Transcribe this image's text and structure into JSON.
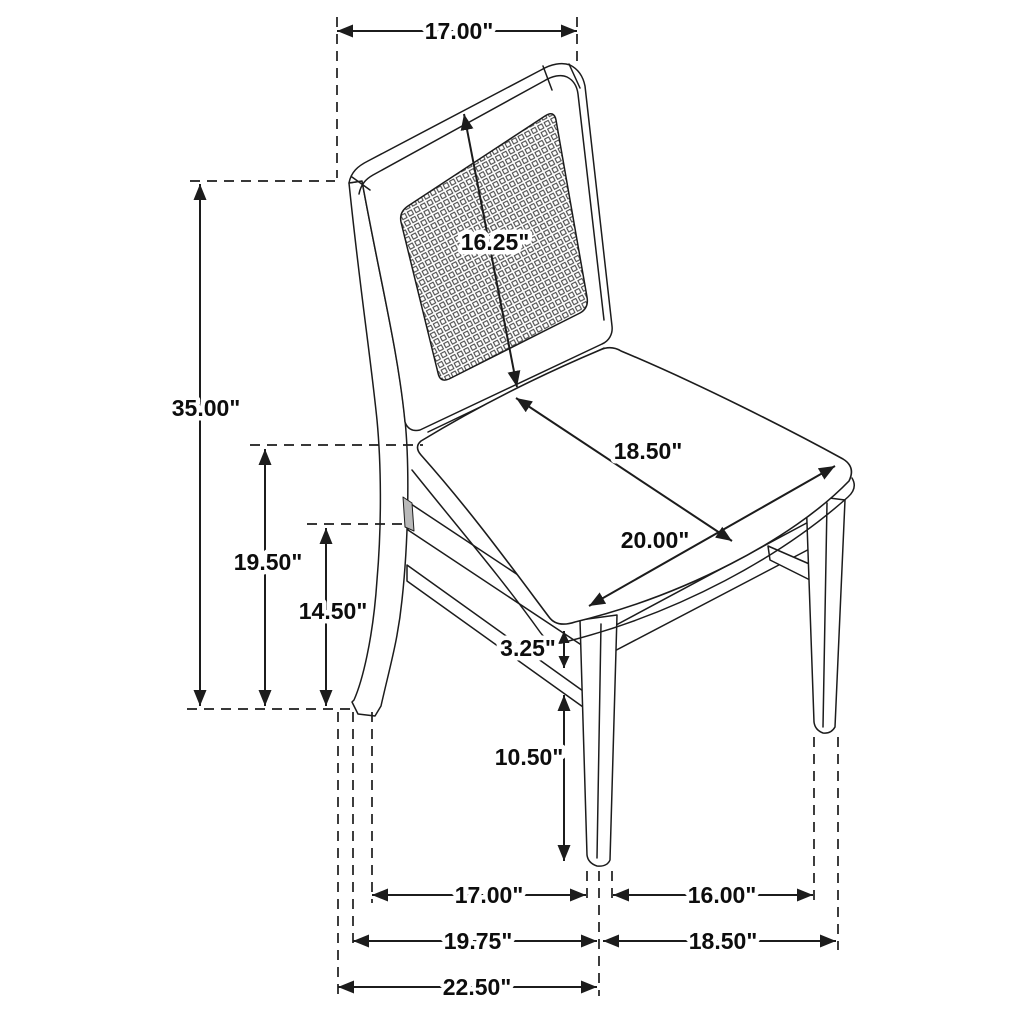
{
  "diagram": {
    "type": "furniture-dimension-drawing",
    "unit": "inches",
    "colors": {
      "line": "#1c1c1c",
      "label": "#0d0d0d",
      "background": "#ffffff",
      "cane_mesh": "#3c3c3c"
    },
    "dimensions": [
      {
        "id": "back_top_width",
        "label": "17.00\""
      },
      {
        "id": "back_panel_diagonal",
        "label": "16.25\""
      },
      {
        "id": "overall_height",
        "label": "35.00\""
      },
      {
        "id": "back_post_height",
        "label": "19.50\""
      },
      {
        "id": "seat_frame_height",
        "label": "14.50\""
      },
      {
        "id": "seat_depth",
        "label": "18.50\""
      },
      {
        "id": "seat_width",
        "label": "20.00\""
      },
      {
        "id": "apron_height",
        "label": "3.25\""
      },
      {
        "id": "leg_height",
        "label": "10.50\""
      },
      {
        "id": "floor_depth_inner",
        "label": "17.00\""
      },
      {
        "id": "floor_width_inner",
        "label": "16.00\""
      },
      {
        "id": "floor_depth_mid",
        "label": "19.75\""
      },
      {
        "id": "floor_width_outer",
        "label": "18.50\""
      },
      {
        "id": "floor_depth_overall",
        "label": "22.50\""
      }
    ]
  }
}
